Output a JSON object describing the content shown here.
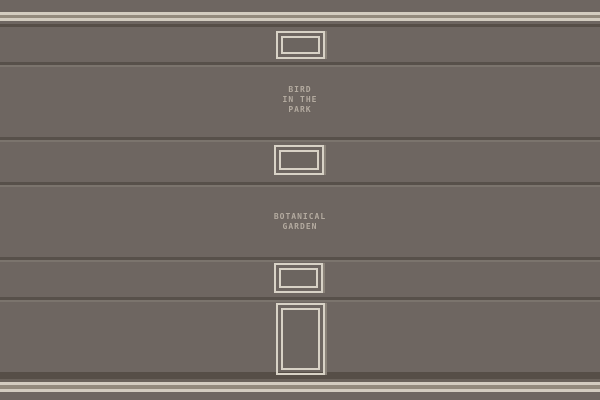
{
  "colors": {
    "wall": "#6e6661",
    "panel-groove": "#57504a",
    "groove-highlight": "#7b746d",
    "trim-light": "#d3ccc0",
    "trim-gap": "#938a7d",
    "trim-mid": "#6a625b",
    "trim-dark": "#564e47",
    "frame-border": "#d8d2c6",
    "frame-shadow": "#8b8379",
    "frame-interior": "#6c6560",
    "label-text": "#b4aba0"
  },
  "wall": {
    "labels": [
      {
        "name": "bird-in-the-park",
        "lines": [
          "BIRD",
          "IN THE",
          "PARK"
        ]
      },
      {
        "name": "botanical-garden",
        "lines": [
          "BOTANICAL",
          "GARDEN"
        ]
      }
    ],
    "frames": [
      {
        "name": "empty-picture-frame-1",
        "orientation": "landscape"
      },
      {
        "name": "empty-picture-frame-2",
        "orientation": "landscape"
      },
      {
        "name": "empty-picture-frame-3",
        "orientation": "landscape"
      },
      {
        "name": "empty-picture-frame-4",
        "orientation": "portrait"
      }
    ]
  }
}
